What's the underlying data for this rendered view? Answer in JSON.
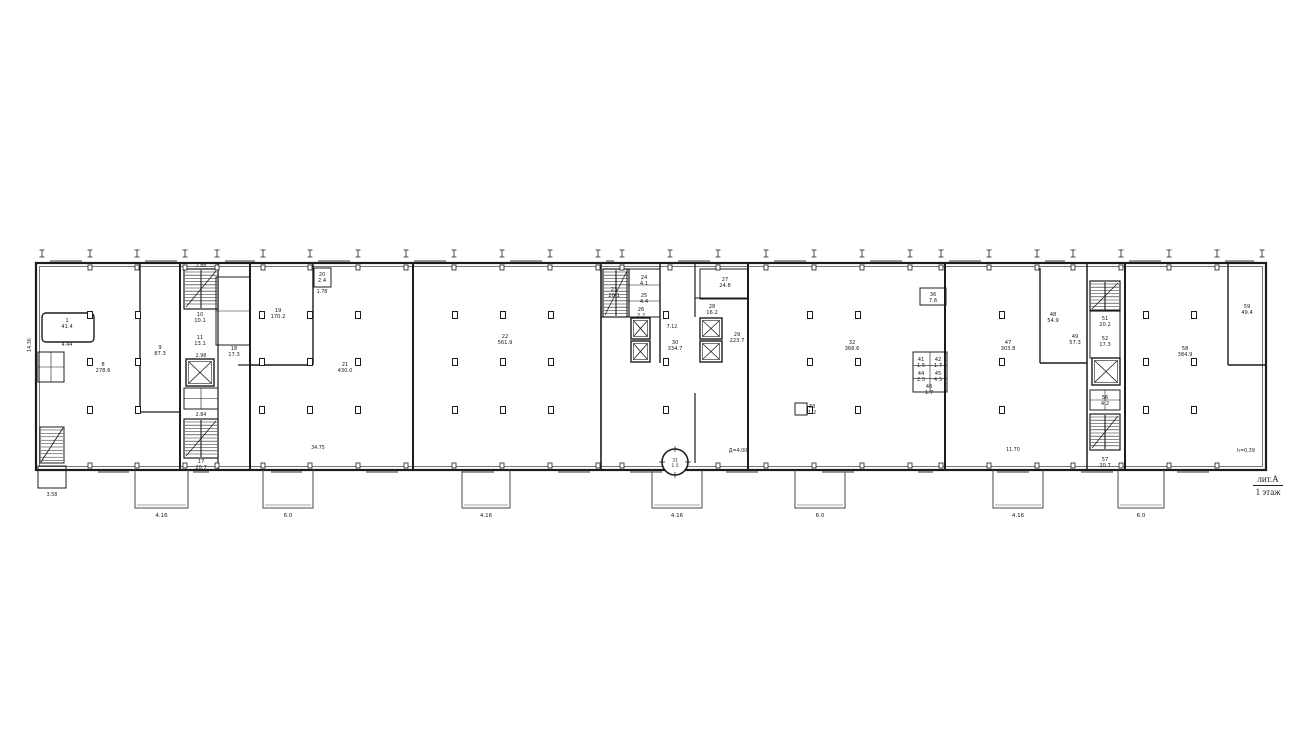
{
  "title_block": {
    "lit": "лит.А",
    "floor": "1 этаж"
  },
  "colors": {
    "ink": "#1c1c1c",
    "faint": "#4a4a4a",
    "window": "#9a9a9a",
    "paper": "#ffffff"
  },
  "plan": {
    "outer": {
      "x": 36,
      "y": 263,
      "w": 1230,
      "h": 207
    },
    "ticks": {
      "xs": [
        42,
        90,
        137,
        185,
        217,
        263,
        310,
        358,
        406,
        454,
        502,
        550,
        598,
        622,
        670,
        718,
        766,
        814,
        862,
        910,
        941,
        989,
        1037,
        1073,
        1121,
        1169,
        1217,
        1262
      ],
      "y": 250
    },
    "column_rows": [
      315,
      362,
      410
    ],
    "column_xs": [
      90,
      138,
      262,
      310,
      358,
      455,
      503,
      551,
      666,
      810,
      858,
      1002,
      1146,
      1194
    ],
    "column_excluderects": [],
    "walls": [
      [
        140,
        263,
        140,
        412,
        1.4
      ],
      [
        140,
        412,
        180,
        412,
        1.2
      ],
      [
        180,
        263,
        180,
        470,
        2
      ],
      [
        218,
        263,
        218,
        470,
        1.2
      ],
      [
        250,
        263,
        250,
        470,
        2
      ],
      [
        238,
        365,
        250,
        365,
        1.2
      ],
      [
        313,
        263,
        313,
        365,
        1.4
      ],
      [
        250,
        365,
        313,
        365,
        1.4
      ],
      [
        413,
        263,
        413,
        470,
        2
      ],
      [
        601,
        263,
        601,
        470,
        1.6
      ],
      [
        660,
        263,
        660,
        363,
        1.4
      ],
      [
        601,
        317,
        660,
        317,
        1.1
      ],
      [
        695,
        263,
        695,
        317,
        1.2
      ],
      [
        695,
        298,
        748,
        298,
        1.1
      ],
      [
        695,
        393,
        695,
        463,
        1.2
      ],
      [
        748,
        263,
        748,
        470,
        2
      ],
      [
        945,
        263,
        945,
        470,
        2
      ],
      [
        1040,
        268,
        1040,
        363,
        1.4
      ],
      [
        1040,
        363,
        1087,
        363,
        1.4
      ],
      [
        1087,
        263,
        1087,
        470,
        1.5
      ],
      [
        1125,
        263,
        1125,
        470,
        2
      ],
      [
        1228,
        263,
        1228,
        365,
        1.4
      ],
      [
        1228,
        365,
        1266,
        365,
        1.4
      ]
    ],
    "stairs": [
      [
        184,
        269,
        34,
        40
      ],
      [
        184,
        419,
        34,
        39
      ],
      [
        603,
        269,
        26,
        48
      ],
      [
        1090,
        281,
        30,
        30
      ],
      [
        1090,
        414,
        30,
        36
      ]
    ],
    "stair_diag": [
      [
        40,
        427,
        24,
        36
      ]
    ],
    "elevators": [
      [
        186,
        359,
        28,
        27
      ],
      [
        631,
        318,
        19,
        21
      ],
      [
        631,
        341,
        19,
        21
      ],
      [
        700,
        318,
        22,
        21
      ],
      [
        700,
        341,
        22,
        21
      ],
      [
        1092,
        358,
        28,
        27
      ]
    ],
    "cells": [
      [
        184,
        388,
        34,
        21,
        2,
        2
      ],
      [
        913,
        352,
        34,
        40,
        2,
        3
      ],
      [
        1090,
        390,
        30,
        20,
        2,
        2
      ],
      [
        627,
        269,
        33,
        48,
        1,
        3
      ],
      [
        700,
        269,
        48,
        30,
        1,
        1
      ],
      [
        38,
        352,
        26,
        30,
        2,
        2
      ],
      [
        216,
        277,
        34,
        68,
        1,
        2
      ]
    ],
    "boxes": [
      [
        314,
        268,
        17,
        19
      ],
      [
        920,
        288,
        26,
        17
      ],
      [
        795,
        403,
        12,
        12
      ],
      [
        38,
        466,
        28,
        22
      ],
      [
        1090,
        310,
        30,
        48
      ]
    ],
    "platform": {
      "x": 42,
      "y": 313,
      "w": 52,
      "h": 29
    },
    "circle": {
      "cx": 675,
      "cy": 462,
      "r": 13,
      "num": "31",
      "area": "1.5"
    },
    "porches": [
      {
        "x": 135,
        "w": 53,
        "dim": "4.16"
      },
      {
        "x": 263,
        "w": 50,
        "dim": "6.0"
      },
      {
        "x": 462,
        "w": 48,
        "dim": "4.16"
      },
      {
        "x": 652,
        "w": 50,
        "dim": "4.16"
      },
      {
        "x": 795,
        "w": 50,
        "dim": "6.0"
      },
      {
        "x": 993,
        "w": 50,
        "dim": "4.16"
      },
      {
        "x": 1118,
        "w": 46,
        "dim": "6.0"
      }
    ],
    "porch_y": 470,
    "porch_h": 38
  },
  "room_labels": [
    {
      "num": "1",
      "area": "41.4",
      "x": 67,
      "y": 322
    },
    {
      "num": "8",
      "area": "278.6",
      "x": 103,
      "y": 366
    },
    {
      "num": "9",
      "area": "87.3",
      "x": 160,
      "y": 349
    },
    {
      "num": "10",
      "area": "10.1",
      "x": 200,
      "y": 316
    },
    {
      "num": "11",
      "area": "13.1",
      "x": 200,
      "y": 339
    },
    {
      "num": "17",
      "area": "20.7",
      "x": 201,
      "y": 463
    },
    {
      "num": "18",
      "area": "17.3",
      "x": 234,
      "y": 350
    },
    {
      "num": "19",
      "area": "170.2",
      "x": 278,
      "y": 312
    },
    {
      "num": "20",
      "area": "2.4",
      "x": 322,
      "y": 276
    },
    {
      "num": "21",
      "area": "430.0",
      "x": 345,
      "y": 366
    },
    {
      "num": "22",
      "area": "561.9",
      "x": 505,
      "y": 338
    },
    {
      "num": "23",
      "area": "20.1",
      "x": 614,
      "y": 291
    },
    {
      "num": "24",
      "area": "4.1",
      "x": 644,
      "y": 279
    },
    {
      "num": "25",
      "area": "4.4",
      "x": 644,
      "y": 297
    },
    {
      "num": "26",
      "area": "2.2",
      "x": 641,
      "y": 311
    },
    {
      "num": "27",
      "area": "24.8",
      "x": 725,
      "y": 281
    },
    {
      "num": "28",
      "area": "16.2",
      "x": 712,
      "y": 308
    },
    {
      "num": "29",
      "area": "223.7",
      "x": 737,
      "y": 336
    },
    {
      "num": "30",
      "area": "334.7",
      "x": 675,
      "y": 344
    },
    {
      "num": "32",
      "area": "368.6",
      "x": 852,
      "y": 344
    },
    {
      "num": "33",
      "area": "1.2",
      "x": 812,
      "y": 408
    },
    {
      "num": "36",
      "area": "7.6",
      "x": 933,
      "y": 296
    },
    {
      "num": "41",
      "area": "1.5",
      "x": 921,
      "y": 361
    },
    {
      "num": "42",
      "area": "1.7",
      "x": 938,
      "y": 361
    },
    {
      "num": "44",
      "area": "2.5",
      "x": 921,
      "y": 375
    },
    {
      "num": "45",
      "area": "4.5",
      "x": 938,
      "y": 375
    },
    {
      "num": "46",
      "area": "1.7",
      "x": 929,
      "y": 388
    },
    {
      "num": "47",
      "area": "303.8",
      "x": 1008,
      "y": 344
    },
    {
      "num": "48",
      "area": "54.9",
      "x": 1053,
      "y": 316
    },
    {
      "num": "49",
      "area": "57.3",
      "x": 1075,
      "y": 338
    },
    {
      "num": "51",
      "area": "20.2",
      "x": 1105,
      "y": 320
    },
    {
      "num": "52",
      "area": "17.3",
      "x": 1105,
      "y": 340
    },
    {
      "num": "56",
      "area": "4.2",
      "x": 1105,
      "y": 399
    },
    {
      "num": "57",
      "area": "20.7",
      "x": 1105,
      "y": 461
    },
    {
      "num": "58",
      "area": "384.9",
      "x": 1185,
      "y": 350
    },
    {
      "num": "59",
      "area": "49.4",
      "x": 1247,
      "y": 308
    }
  ],
  "dim_labels": [
    {
      "t": "2.88",
      "x": 201,
      "y": 267,
      "r": 0
    },
    {
      "t": "2.98",
      "x": 201,
      "y": 357,
      "r": 0
    },
    {
      "t": "2.84",
      "x": 201,
      "y": 416,
      "r": 0
    },
    {
      "t": "1.78",
      "x": 322,
      "y": 293,
      "r": 0
    },
    {
      "t": "4.44",
      "x": 67,
      "y": 346,
      "r": 0
    },
    {
      "t": "34.75",
      "x": 318,
      "y": 449,
      "r": 0
    },
    {
      "t": "7.12",
      "x": 672,
      "y": 328,
      "r": 0
    },
    {
      "t": "Д=4,00",
      "x": 738,
      "y": 452,
      "r": 0
    },
    {
      "t": "11.70",
      "x": 1013,
      "y": 451,
      "r": 0
    },
    {
      "t": "h=0,39",
      "x": 1246,
      "y": 452,
      "r": 0
    },
    {
      "t": "3.58",
      "x": 52,
      "y": 496,
      "r": 0
    },
    {
      "t": "14.36",
      "x": 31,
      "y": 345,
      "r": -90
    }
  ]
}
